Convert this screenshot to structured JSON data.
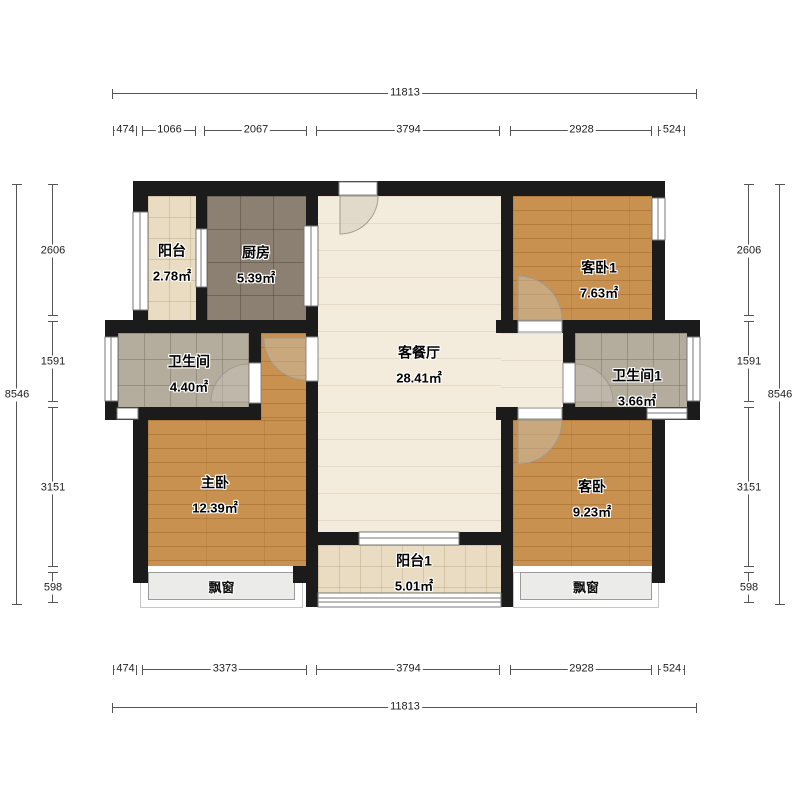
{
  "plan": {
    "rooms": {
      "balcony": {
        "name": "阳台",
        "area": "2.78㎡"
      },
      "kitchen": {
        "name": "厨房",
        "area": "5.39㎡"
      },
      "living": {
        "name": "客餐厅",
        "area": "28.41㎡"
      },
      "bedroom1": {
        "name": "客卧1",
        "area": "7.63㎡"
      },
      "bath": {
        "name": "卫生间",
        "area": "4.40㎡"
      },
      "bath1": {
        "name": "卫生间1",
        "area": "3.66㎡"
      },
      "master": {
        "name": "主卧",
        "area": "12.39㎡"
      },
      "bedroom2": {
        "name": "客卧",
        "area": "9.23㎡"
      },
      "balcony1": {
        "name": "阳台1",
        "area": "5.01㎡"
      }
    },
    "bay_windows": {
      "left_label": "飘窗",
      "right_label": "飘窗"
    },
    "dimensions": {
      "top": {
        "total": "11813",
        "segments": [
          "474",
          "1066",
          "2067",
          "3794",
          "2928",
          "524"
        ]
      },
      "bottom": {
        "total": "11813",
        "segments": [
          "474",
          "3373",
          "3794",
          "2928",
          "524"
        ]
      },
      "left": {
        "total": "8546",
        "segments": [
          "2606",
          "1591",
          "3151",
          "598"
        ]
      },
      "right": {
        "total": "8546",
        "segments": [
          "2606",
          "1591",
          "3151",
          "598"
        ]
      }
    },
    "colors": {
      "wall": "#1b1b1b",
      "wood_floor": "#c8914f",
      "living_floor": "#f3ebdb",
      "balcony_tile": "#e9dcc2",
      "kitchen_tile": "#8b8071",
      "bath_tile": "#b4ad9e",
      "bay_window": "#ebebe9",
      "dimension_line": "#555555"
    }
  }
}
